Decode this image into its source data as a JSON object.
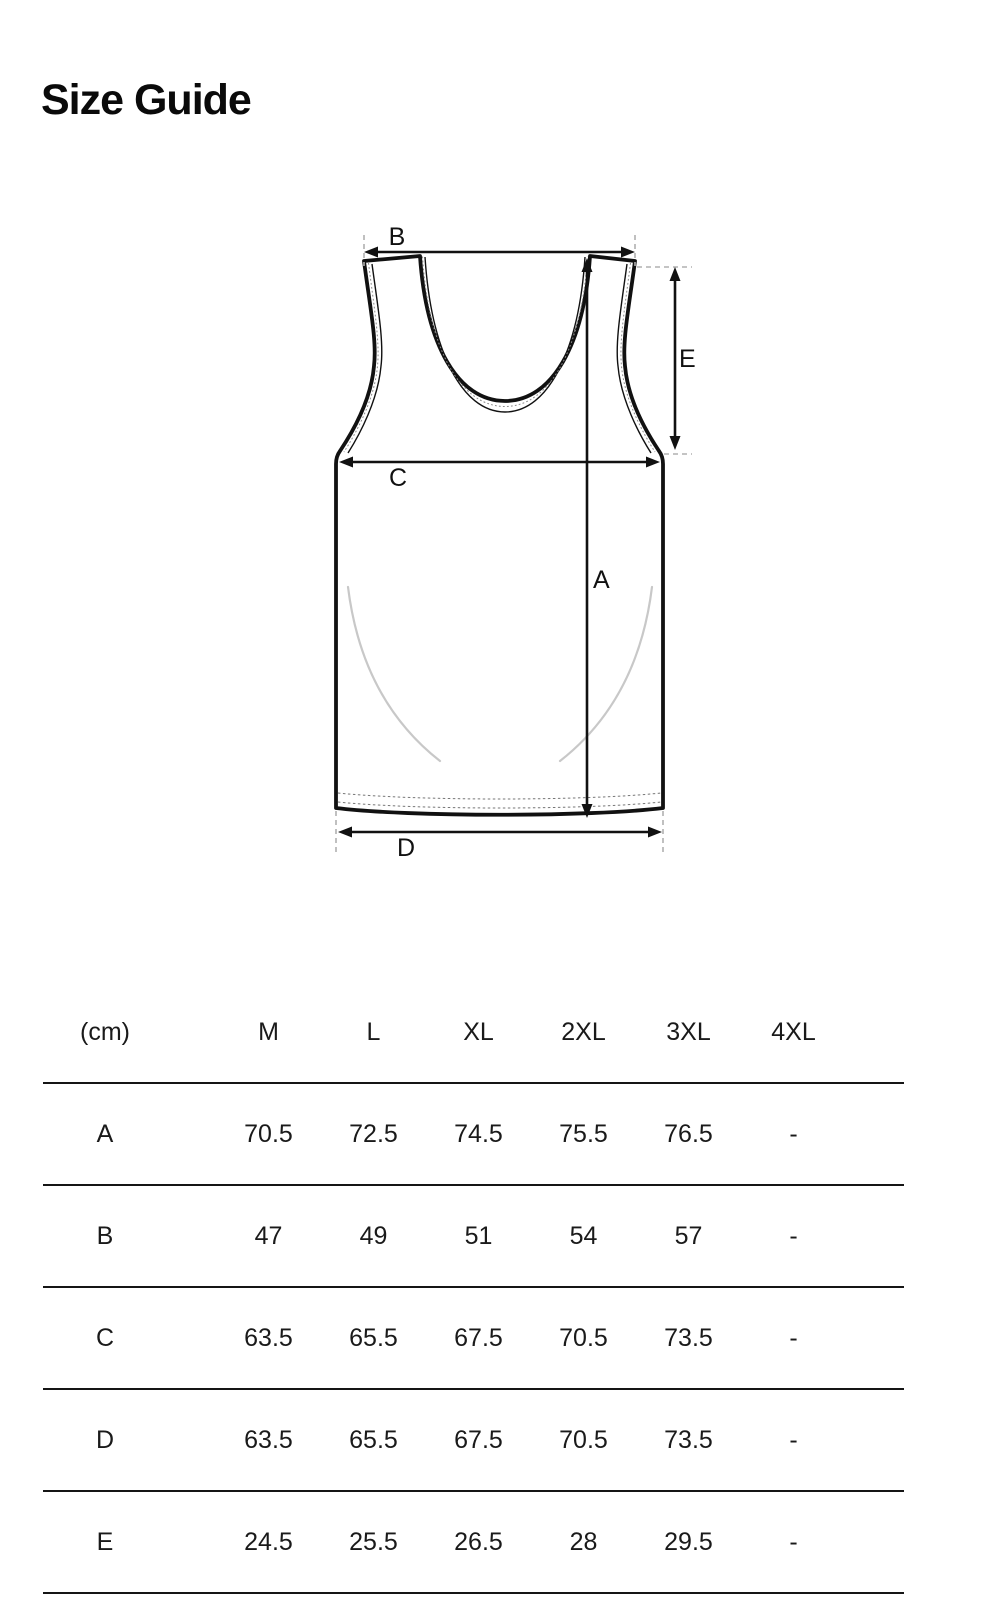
{
  "page": {
    "title": "Size Guide"
  },
  "colors": {
    "line": "#111111",
    "table_line": "#151515",
    "guide_dash": "#b0b0b0",
    "stitch": "#8a8a8a",
    "drape": "#c8c8c8",
    "background": "#ffffff"
  },
  "diagram": {
    "garment": "tank-top-front-view",
    "labels": {
      "A": "A",
      "B": "B",
      "C": "C",
      "D": "D",
      "E": "E"
    }
  },
  "table": {
    "unit_header": "(cm)",
    "columns": [
      "M",
      "L",
      "XL",
      "2XL",
      "3XL",
      "4XL"
    ],
    "rows": [
      {
        "label": "A",
        "values": [
          "70.5",
          "72.5",
          "74.5",
          "75.5",
          "76.5",
          "-"
        ]
      },
      {
        "label": "B",
        "values": [
          "47",
          "49",
          "51",
          "54",
          "57",
          "-"
        ]
      },
      {
        "label": "C",
        "values": [
          "63.5",
          "65.5",
          "67.5",
          "70.5",
          "73.5",
          "-"
        ]
      },
      {
        "label": "D",
        "values": [
          "63.5",
          "65.5",
          "67.5",
          "70.5",
          "73.5",
          "-"
        ]
      },
      {
        "label": "E",
        "values": [
          "24.5",
          "25.5",
          "26.5",
          "28",
          "29.5",
          "-"
        ]
      }
    ]
  }
}
